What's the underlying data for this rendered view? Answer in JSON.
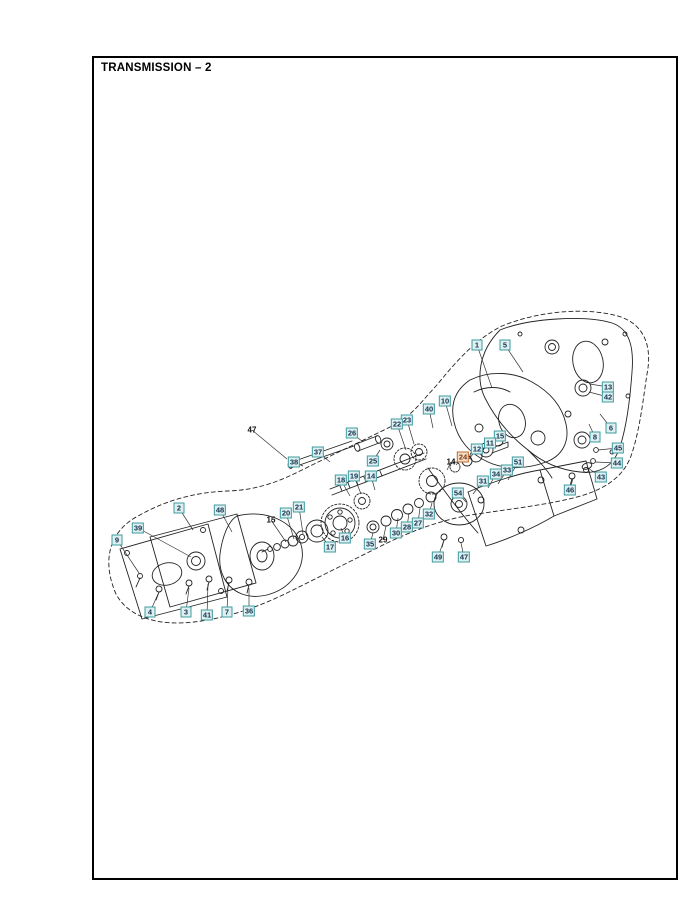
{
  "page": {
    "title": "TRANSMISSION – 2"
  },
  "diagram": {
    "colors": {
      "box_border": "#3f9ca0",
      "box_fill": "#ddeff0",
      "box_text": "#14324e",
      "highlight_border": "#c06a2e",
      "highlight_fill": "#f4e0c8",
      "highlight_text": "#7d3410",
      "line_art": "#222222",
      "leader": "#333333"
    },
    "callouts": [
      {
        "n": "1",
        "x": 477,
        "y": 345,
        "lx": 492,
        "ly": 388,
        "s": "box"
      },
      {
        "n": "5",
        "x": 505,
        "y": 345,
        "lx": 523,
        "ly": 372,
        "s": "box"
      },
      {
        "n": "13",
        "x": 608,
        "y": 387,
        "lx": 590,
        "ly": 384,
        "s": "box"
      },
      {
        "n": "42",
        "x": 608,
        "y": 397,
        "lx": 589,
        "ly": 392,
        "s": "box"
      },
      {
        "n": "6",
        "x": 611,
        "y": 428,
        "lx": 600,
        "ly": 414,
        "s": "box"
      },
      {
        "n": "8",
        "x": 595,
        "y": 437,
        "lx": 589,
        "ly": 424,
        "s": "box"
      },
      {
        "n": "45",
        "x": 618,
        "y": 448,
        "lx": 598,
        "ly": 450,
        "s": "box"
      },
      {
        "n": "44",
        "x": 617,
        "y": 463,
        "lx": 595,
        "ly": 462,
        "s": "box"
      },
      {
        "n": "43",
        "x": 601,
        "y": 477,
        "lx": 588,
        "ly": 468,
        "s": "box"
      },
      {
        "n": "46",
        "x": 570,
        "y": 490,
        "lx": 573,
        "ly": 478,
        "s": "box"
      },
      {
        "n": "10",
        "x": 445,
        "y": 401,
        "lx": 452,
        "ly": 426,
        "s": "box"
      },
      {
        "n": "40",
        "x": 429,
        "y": 409,
        "lx": 433,
        "ly": 428,
        "s": "box"
      },
      {
        "n": "23",
        "x": 407,
        "y": 420,
        "lx": 414,
        "ly": 444,
        "s": "box"
      },
      {
        "n": "22",
        "x": 397,
        "y": 424,
        "lx": 406,
        "ly": 450,
        "s": "box"
      },
      {
        "n": "26",
        "x": 352,
        "y": 433,
        "lx": 363,
        "ly": 442,
        "s": "box"
      },
      {
        "n": "37",
        "x": 318,
        "y": 452,
        "lx": 330,
        "ly": 462,
        "s": "box"
      },
      {
        "n": "38",
        "x": 294,
        "y": 462,
        "lx": 303,
        "ly": 466,
        "s": "box"
      },
      {
        "n": "47",
        "x": 252,
        "y": 430,
        "lx": 287,
        "ly": 459,
        "s": "plain"
      },
      {
        "n": "25",
        "x": 373,
        "y": 461,
        "lx": 380,
        "ly": 450,
        "s": "box"
      },
      {
        "n": "19",
        "x": 354,
        "y": 476,
        "lx": 361,
        "ly": 494,
        "s": "box"
      },
      {
        "n": "14",
        "x": 371,
        "y": 476,
        "lx": 375,
        "ly": 490,
        "s": "box"
      },
      {
        "n": "18",
        "x": 341,
        "y": 480,
        "lx": 350,
        "ly": 496,
        "s": "box"
      },
      {
        "n": "15",
        "x": 500,
        "y": 436,
        "lx": 488,
        "ly": 448,
        "s": "box"
      },
      {
        "n": "11",
        "x": 490,
        "y": 443,
        "lx": 479,
        "ly": 454,
        "s": "box"
      },
      {
        "n": "12",
        "x": 477,
        "y": 449,
        "lx": 469,
        "ly": 459,
        "s": "box"
      },
      {
        "n": "24",
        "x": 463,
        "y": 457,
        "lx": 456,
        "ly": 465,
        "s": "highlight"
      },
      {
        "n": "14",
        "x": 451,
        "y": 462,
        "lx": 447,
        "ly": 470,
        "s": "plain"
      },
      {
        "n": "51",
        "x": 518,
        "y": 462,
        "lx": 508,
        "ly": 480,
        "s": "box"
      },
      {
        "n": "33",
        "x": 507,
        "y": 470,
        "lx": 498,
        "ly": 484,
        "s": "box"
      },
      {
        "n": "34",
        "x": 496,
        "y": 474,
        "lx": 488,
        "ly": 488,
        "s": "box"
      },
      {
        "n": "31",
        "x": 483,
        "y": 481,
        "lx": 473,
        "ly": 494,
        "s": "box"
      },
      {
        "n": "54",
        "x": 458,
        "y": 493,
        "lx": 466,
        "ly": 502,
        "s": "box"
      },
      {
        "n": "32",
        "x": 429,
        "y": 514,
        "lx": 432,
        "ly": 503,
        "s": "box"
      },
      {
        "n": "27",
        "x": 418,
        "y": 523,
        "lx": 420,
        "ly": 508,
        "s": "box"
      },
      {
        "n": "28",
        "x": 407,
        "y": 527,
        "lx": 409,
        "ly": 513,
        "s": "box"
      },
      {
        "n": "30",
        "x": 396,
        "y": 533,
        "lx": 398,
        "ly": 518,
        "s": "box"
      },
      {
        "n": "29",
        "x": 383,
        "y": 540,
        "lx": 386,
        "ly": 526,
        "s": "plain"
      },
      {
        "n": "35",
        "x": 370,
        "y": 544,
        "lx": 373,
        "ly": 533,
        "s": "box"
      },
      {
        "n": "16",
        "x": 345,
        "y": 538,
        "lx": 341,
        "ly": 528,
        "s": "box"
      },
      {
        "n": "17",
        "x": 330,
        "y": 547,
        "lx": 322,
        "ly": 537,
        "s": "box"
      },
      {
        "n": "49",
        "x": 438,
        "y": 557,
        "lx": 444,
        "ly": 540,
        "s": "box"
      },
      {
        "n": "47",
        "x": 464,
        "y": 557,
        "lx": 461,
        "ly": 543,
        "s": "box"
      },
      {
        "n": "21",
        "x": 299,
        "y": 507,
        "lx": 303,
        "ly": 534,
        "s": "box"
      },
      {
        "n": "20",
        "x": 286,
        "y": 513,
        "lx": 294,
        "ly": 539,
        "s": "box"
      },
      {
        "n": "15",
        "x": 271,
        "y": 520,
        "lx": 286,
        "ly": 542,
        "s": "plain"
      },
      {
        "n": "2",
        "x": 179,
        "y": 508,
        "lx": 193,
        "ly": 530,
        "s": "box"
      },
      {
        "n": "48",
        "x": 220,
        "y": 510,
        "lx": 232,
        "ly": 532,
        "s": "box"
      },
      {
        "n": "39",
        "x": 138,
        "y": 528,
        "lx": 191,
        "ly": 557,
        "s": "box"
      },
      {
        "n": "9",
        "x": 117,
        "y": 540,
        "lx": 139,
        "ly": 573,
        "s": "box"
      },
      {
        "n": "4",
        "x": 150,
        "y": 612,
        "lx": 158,
        "ly": 594,
        "s": "box"
      },
      {
        "n": "3",
        "x": 186,
        "y": 612,
        "lx": 189,
        "ly": 588,
        "s": "box"
      },
      {
        "n": "41",
        "x": 207,
        "y": 615,
        "lx": 208,
        "ly": 584,
        "s": "box"
      },
      {
        "n": "7",
        "x": 227,
        "y": 612,
        "lx": 228,
        "ly": 586,
        "s": "box"
      },
      {
        "n": "36",
        "x": 249,
        "y": 611,
        "lx": 249,
        "ly": 588,
        "s": "box"
      }
    ]
  }
}
